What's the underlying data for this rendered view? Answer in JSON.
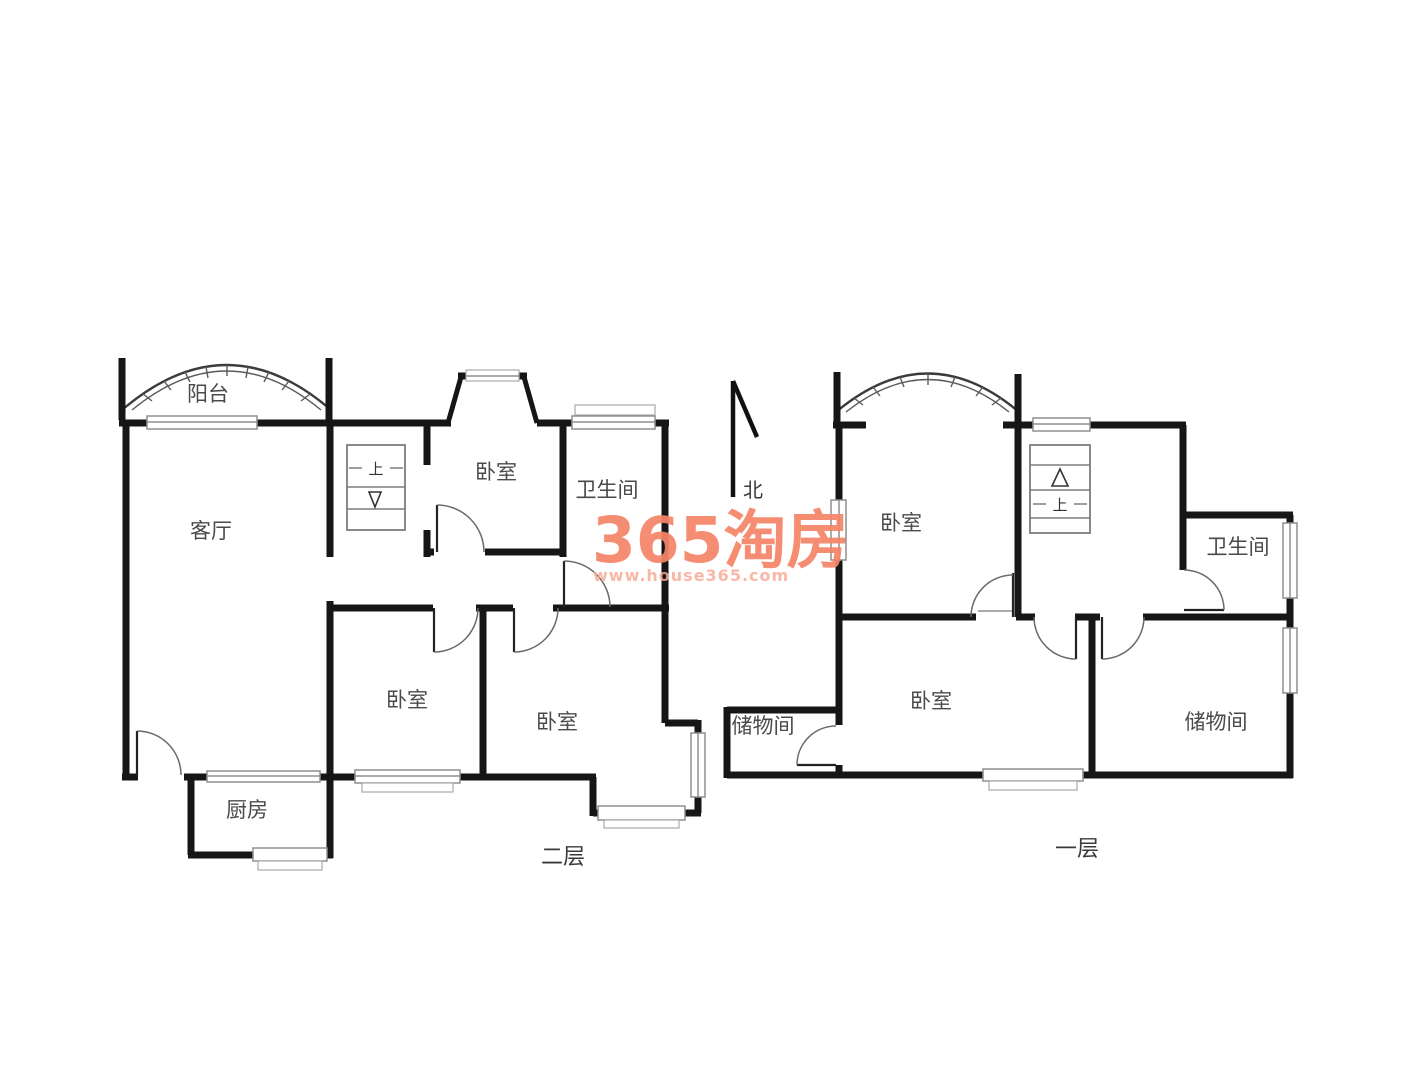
{
  "page": {
    "background": "#ffffff"
  },
  "watermark": {
    "brand": "365淘房",
    "url": "www.house365.com",
    "brand_color": "#f58569",
    "url_color": "#f9ab98"
  },
  "north_indicator": {
    "label": "北"
  },
  "floors": [
    {
      "name": "second-floor",
      "floor_label": "二层",
      "rooms": {
        "balcony": "阳台",
        "living_room": "客厅",
        "bedroom_top": "卧室",
        "bathroom": "卫生间",
        "bedroom_mid_left": "卧室",
        "bedroom_mid_right": "卧室",
        "kitchen": "厨房"
      },
      "stairs": {
        "up_label": "上",
        "arrow": "down"
      }
    },
    {
      "name": "first-floor",
      "floor_label": "一层",
      "rooms": {
        "bedroom_top": "卧室",
        "bathroom": "卫生间",
        "storage_left": "储物间",
        "bedroom_bottom": "卧室",
        "storage_right": "储物间"
      },
      "stairs": {
        "up_label": "上",
        "arrow": "up"
      }
    }
  ]
}
